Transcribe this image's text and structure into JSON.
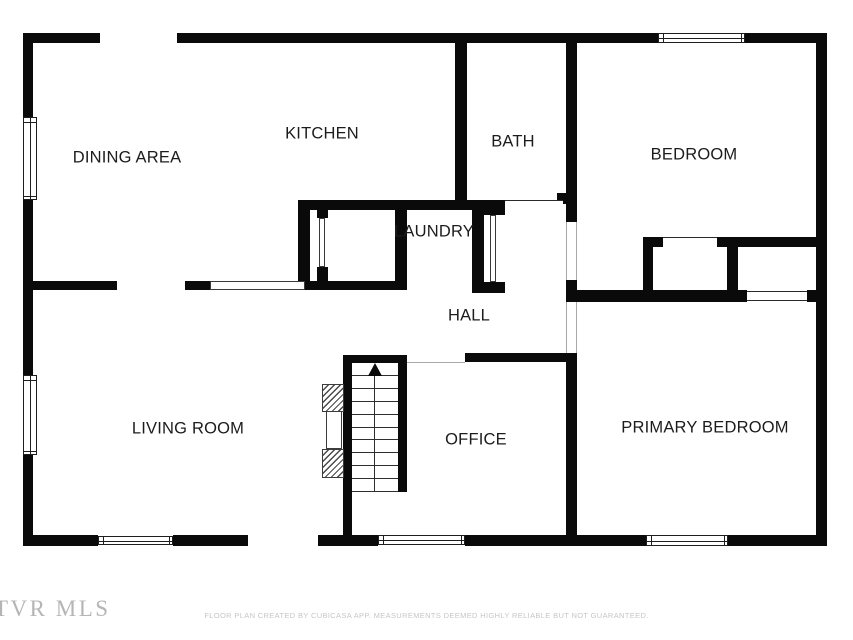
{
  "floorplan": {
    "colors": {
      "wall": "#0a0a0a",
      "label": "#1c1c1c",
      "watermark": "#b5b5b5",
      "footer_text": "#c6c6c6",
      "background": "#ffffff"
    },
    "watermark": "TVR MLS",
    "footer": "FLOOR PLAN CREATED BY CUBICASA APP. MEASUREMENTS DEEMED HIGHLY RELIABLE BUT NOT GUARANTEED.",
    "rooms": [
      {
        "name": "dining-area",
        "label": "DINING AREA",
        "cx": 127,
        "cy": 158
      },
      {
        "name": "kitchen",
        "label": "KITCHEN",
        "cx": 322,
        "cy": 134
      },
      {
        "name": "bath",
        "label": "BATH",
        "cx": 513,
        "cy": 142
      },
      {
        "name": "bedroom",
        "label": "BEDROOM",
        "cx": 694,
        "cy": 155
      },
      {
        "name": "laundry",
        "label": "LAUNDRY",
        "cx": 434,
        "cy": 232
      },
      {
        "name": "hall",
        "label": "HALL",
        "cx": 469,
        "cy": 316
      },
      {
        "name": "living-room",
        "label": "LIVING ROOM",
        "cx": 188,
        "cy": 429
      },
      {
        "name": "office",
        "label": "OFFICE",
        "cx": 476,
        "cy": 440
      },
      {
        "name": "primary-bedroom",
        "label": "PRIMARY BEDROOM",
        "cx": 705,
        "cy": 428
      }
    ],
    "walls": [
      [
        23,
        33,
        77,
        10
      ],
      [
        177,
        33,
        481,
        10
      ],
      [
        745,
        33,
        82,
        10
      ],
      [
        23,
        33,
        10,
        84
      ],
      [
        23,
        200,
        10,
        175
      ],
      [
        23,
        455,
        10,
        91
      ],
      [
        816,
        33,
        11,
        513
      ],
      [
        23,
        535,
        75,
        11
      ],
      [
        173,
        535,
        75,
        11
      ],
      [
        318,
        535,
        60,
        11
      ],
      [
        465,
        535,
        181,
        11
      ],
      [
        728,
        535,
        99,
        11
      ],
      [
        455,
        43,
        12,
        165
      ],
      [
        566,
        43,
        11,
        179
      ],
      [
        557,
        193,
        9,
        11
      ],
      [
        298,
        200,
        207,
        10
      ],
      [
        298,
        200,
        12,
        90
      ],
      [
        395,
        210,
        12,
        80
      ],
      [
        472,
        210,
        12,
        83
      ],
      [
        317,
        210,
        11,
        8
      ],
      [
        317,
        267,
        11,
        14
      ],
      [
        484,
        203,
        21,
        12
      ],
      [
        472,
        282,
        33,
        11
      ],
      [
        23,
        281,
        94,
        9
      ],
      [
        185,
        281,
        25,
        9
      ],
      [
        310,
        281,
        95,
        9
      ],
      [
        566,
        290,
        181,
        12
      ],
      [
        807,
        290,
        9,
        12
      ],
      [
        566,
        280,
        11,
        22
      ],
      [
        643,
        237,
        20,
        10
      ],
      [
        717,
        237,
        99,
        10
      ],
      [
        643,
        247,
        10,
        43
      ],
      [
        727,
        237,
        11,
        53
      ],
      [
        465,
        353,
        105,
        9
      ],
      [
        566,
        353,
        11,
        182
      ],
      [
        343,
        355,
        64,
        8
      ],
      [
        343,
        355,
        9,
        180
      ],
      [
        398,
        363,
        9,
        129
      ]
    ],
    "windows": [
      [
        658,
        33,
        87,
        10,
        "h"
      ],
      [
        23,
        117,
        14,
        83,
        "v"
      ],
      [
        23,
        375,
        14,
        80,
        "v"
      ],
      [
        98,
        536,
        75,
        9,
        "h"
      ],
      [
        378,
        535,
        87,
        10,
        "h"
      ],
      [
        646,
        535,
        82,
        11,
        "h"
      ]
    ],
    "panels": [
      [
        210,
        281,
        95,
        9
      ],
      [
        319,
        218,
        6,
        49
      ],
      [
        490,
        215,
        6,
        67
      ]
    ],
    "openings": [
      [
        566,
        222,
        11,
        58,
        "lr",
        "light"
      ],
      [
        566,
        302,
        11,
        51,
        "lr",
        "light"
      ],
      [
        505,
        200,
        58,
        10,
        "t",
        "dark"
      ],
      [
        407,
        354,
        58,
        9,
        "b",
        "light"
      ],
      [
        663,
        237,
        54,
        10,
        "t",
        "dark"
      ],
      [
        747,
        291,
        60,
        10,
        "tb",
        "dark"
      ]
    ],
    "stairs": {
      "x": 352,
      "y": 363,
      "w": 46,
      "h": 129,
      "treads": 10,
      "rail_x": 374,
      "arrow_tip_y": 363
    },
    "chimney": {
      "box": [
        322,
        384,
        22,
        94
      ],
      "hatch_top": [
        322,
        384,
        22,
        28
      ],
      "mid": [
        326,
        411,
        16,
        38
      ],
      "hatch_bottom": [
        322,
        449,
        22,
        29
      ]
    }
  }
}
